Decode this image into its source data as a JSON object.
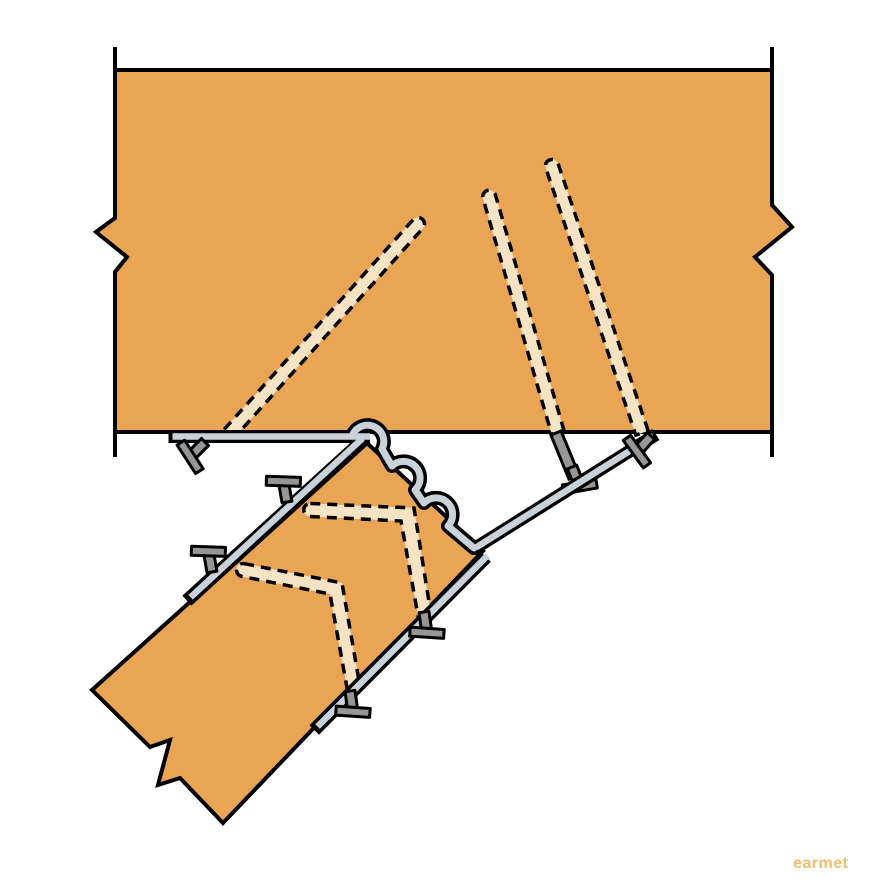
{
  "title": "Sloped joist hanger installation illustration",
  "watermark": {
    "text": "earmet",
    "color": "#f5bb6e"
  },
  "diagram": {
    "type": "technical-line-illustration",
    "subject": "Formed-steel joist hanger attaching a sloped joist to the underside of a header beam",
    "components": [
      {
        "name": "header-beam",
        "description": "Horizontal lumber header drawn with break marks on both cut ends"
      },
      {
        "name": "sloped-joist",
        "description": "Lumber joist sloping down to the lower left, ending in a break mark"
      },
      {
        "name": "joist-hanger",
        "description": "Light-gray steel hanger: top flange under the header, corrugated adjustable seat over the joist end, side flanges along the joist, diagonal strap to the header"
      },
      {
        "name": "hidden-screws-header",
        "count": 3,
        "description": "Dashed outlines of concealed screws driven up through the hanger into the header"
      },
      {
        "name": "bent-screws-joist",
        "count": 2,
        "description": "Dashed outlines of double-shear screws bent at 45 degrees inside the joist"
      },
      {
        "name": "fastener-heads",
        "count": 7,
        "description": "Protruding gray screw heads on the hanger flanges and strap"
      }
    ],
    "colors": {
      "background": "#ffffff",
      "wood": "#e9a454",
      "hidden_screw_fill": "#f6e3c4",
      "steel": "#c9d1d9",
      "fastener": "#969696",
      "outline": "#000000",
      "watermark": "#f5bb6e"
    }
  }
}
